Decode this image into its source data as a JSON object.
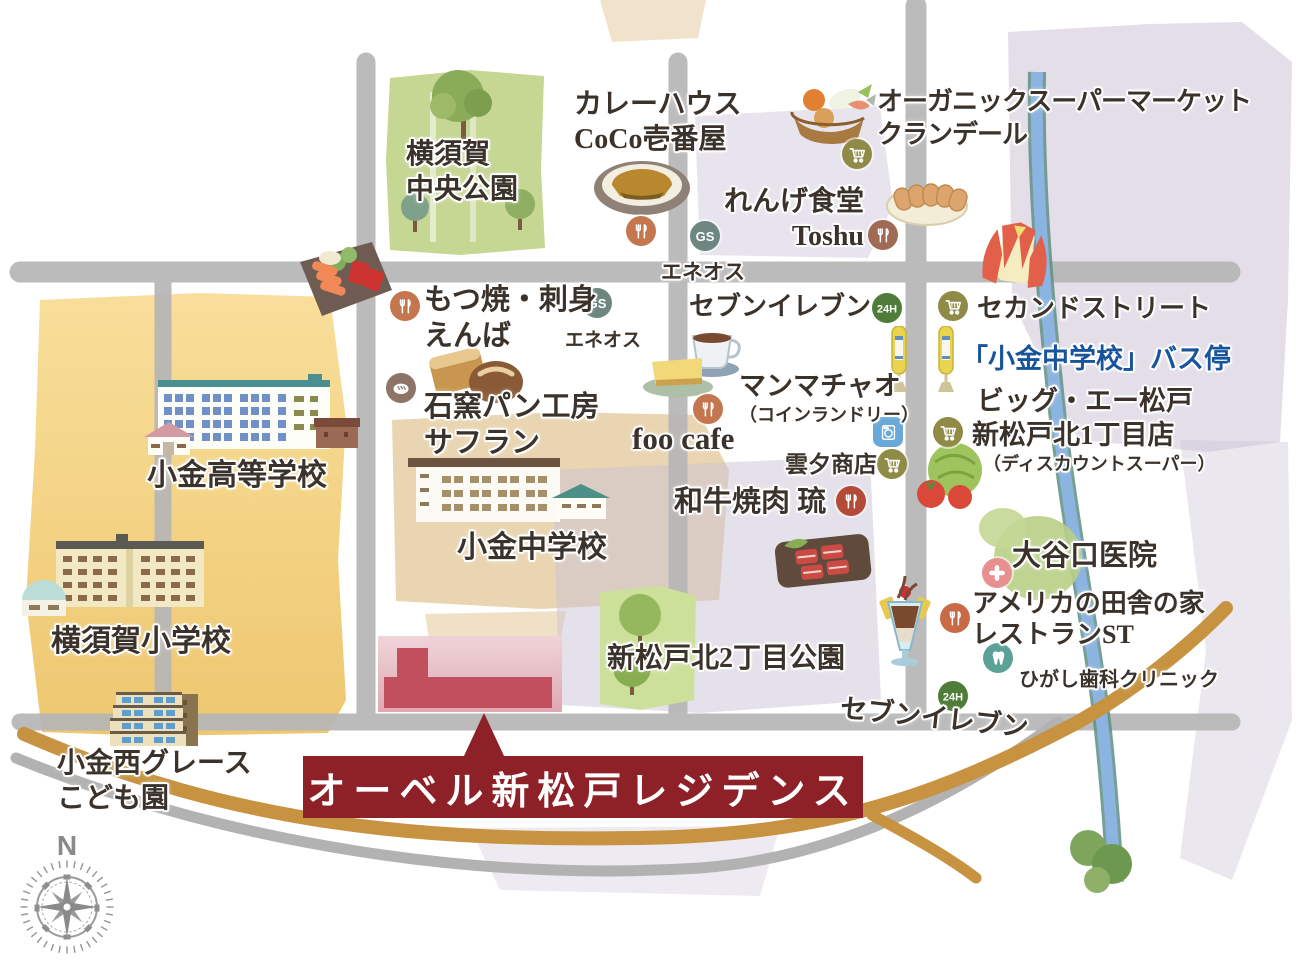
{
  "map": {
    "property_banner": {
      "text": "オーベル新松戸レジデンス"
    },
    "compass_label": "N",
    "badges": {
      "gs": "GS",
      "open24": "24H"
    },
    "colors": {
      "banner_red": "#8e2127",
      "bus_stop_text_blue": "#18549c",
      "road_gray": "#b6b6b6",
      "route_gold": "#c79340",
      "river_blue": "#8cb4e0",
      "park_green": "#c6d693",
      "school_zone_yellow": "#f3cf7d",
      "site_pink": "#e3b3bb",
      "site_building_red": "#c14f5e"
    },
    "icons": {
      "restaurant": "fork-knife",
      "supermarket": "shopping-cart",
      "gas_station": "GS-badge",
      "open_24h": "24H-badge",
      "laundry": "washing-machine",
      "clinic": "medical-cross",
      "dental": "tooth",
      "bakery": "bread",
      "bus_stop": "bus-stop-pole"
    },
    "places": {
      "yokosuka_chuo_park": {
        "lines": [
          "横須賀",
          "中央公園"
        ]
      },
      "coco_ichibanya": {
        "lines": [
          "カレーハウス",
          "CoCo壱番屋"
        ]
      },
      "organic_supermarket": {
        "lines": [
          "オーガニックスーパーマーケット",
          "クランデール"
        ]
      },
      "renge_shokudo_toshu": {
        "lines": [
          "れんげ食堂",
          "Toshu"
        ]
      },
      "eneos_north": {
        "lines": [
          "エネオス"
        ]
      },
      "motsuyaki_enba": {
        "lines": [
          "もつ焼・刺身",
          "えんば"
        ]
      },
      "eneos_west": {
        "lines": [
          "エネオス"
        ]
      },
      "seven_eleven_north": {
        "lines": [
          "セブンイレブン"
        ]
      },
      "second_street": {
        "lines": [
          "セカンドストリート"
        ]
      },
      "kogane_jhs_bus_stop": {
        "lines": [
          "「小金中学校」バス停"
        ]
      },
      "manmachao": {
        "lines": [
          "マンマチャオ",
          "（コインランドリー）"
        ]
      },
      "big_a_matsudo": {
        "lines": [
          "ビッグ・エー松戸",
          "新松戸北1丁目店",
          "（ディスカウントスーパー）"
        ]
      },
      "safran_bakery": {
        "lines": [
          "石窯パン工房",
          "サフラン"
        ]
      },
      "foo_cafe": {
        "lines": [
          "foo cafe"
        ]
      },
      "unyu_shoten": {
        "lines": [
          "雲夕商店"
        ]
      },
      "wagyu_yakiniku_ryu": {
        "lines": [
          "和牛焼肉 琉"
        ]
      },
      "kogane_high_school": {
        "lines": [
          "小金高等学校"
        ]
      },
      "kogane_junior_high_school": {
        "lines": [
          "小金中学校"
        ]
      },
      "yokosuka_elementary_school": {
        "lines": [
          "横須賀小学校"
        ]
      },
      "oyaguchi_clinic": {
        "lines": [
          "大谷口医院"
        ]
      },
      "american_country_restaurant": {
        "lines": [
          "アメリカの田舎の家",
          "レストランST"
        ]
      },
      "higashi_dental_clinic": {
        "lines": [
          "ひがし歯科クリニック"
        ]
      },
      "shinmatsudo_kita2_park": {
        "lines": [
          "新松戸北2丁目公園"
        ]
      },
      "seven_eleven_south": {
        "lines": [
          "セブンイレブン"
        ]
      },
      "kogane_nishi_grace": {
        "lines": [
          "小金西グレース",
          "こども園"
        ]
      }
    }
  }
}
